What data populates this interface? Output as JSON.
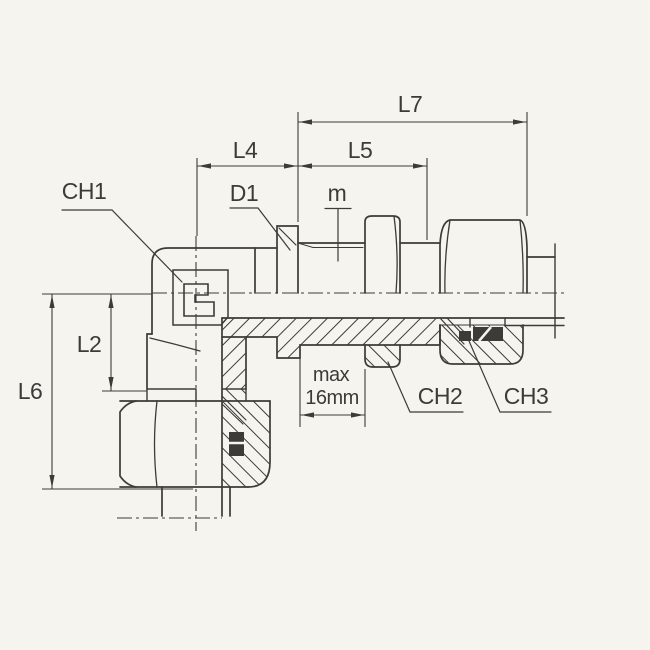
{
  "drawing": {
    "background": "#f5f4ef",
    "ink": "#3c3b38",
    "labels": {
      "ch1": "CH1",
      "d1": "D1",
      "m": "m",
      "l4": "L4",
      "l5": "L5",
      "l7": "L7",
      "l2": "L2",
      "l6": "L6",
      "max_line1": "max",
      "max_line2": "16mm",
      "ch2": "CH2",
      "ch3": "CH3"
    }
  }
}
